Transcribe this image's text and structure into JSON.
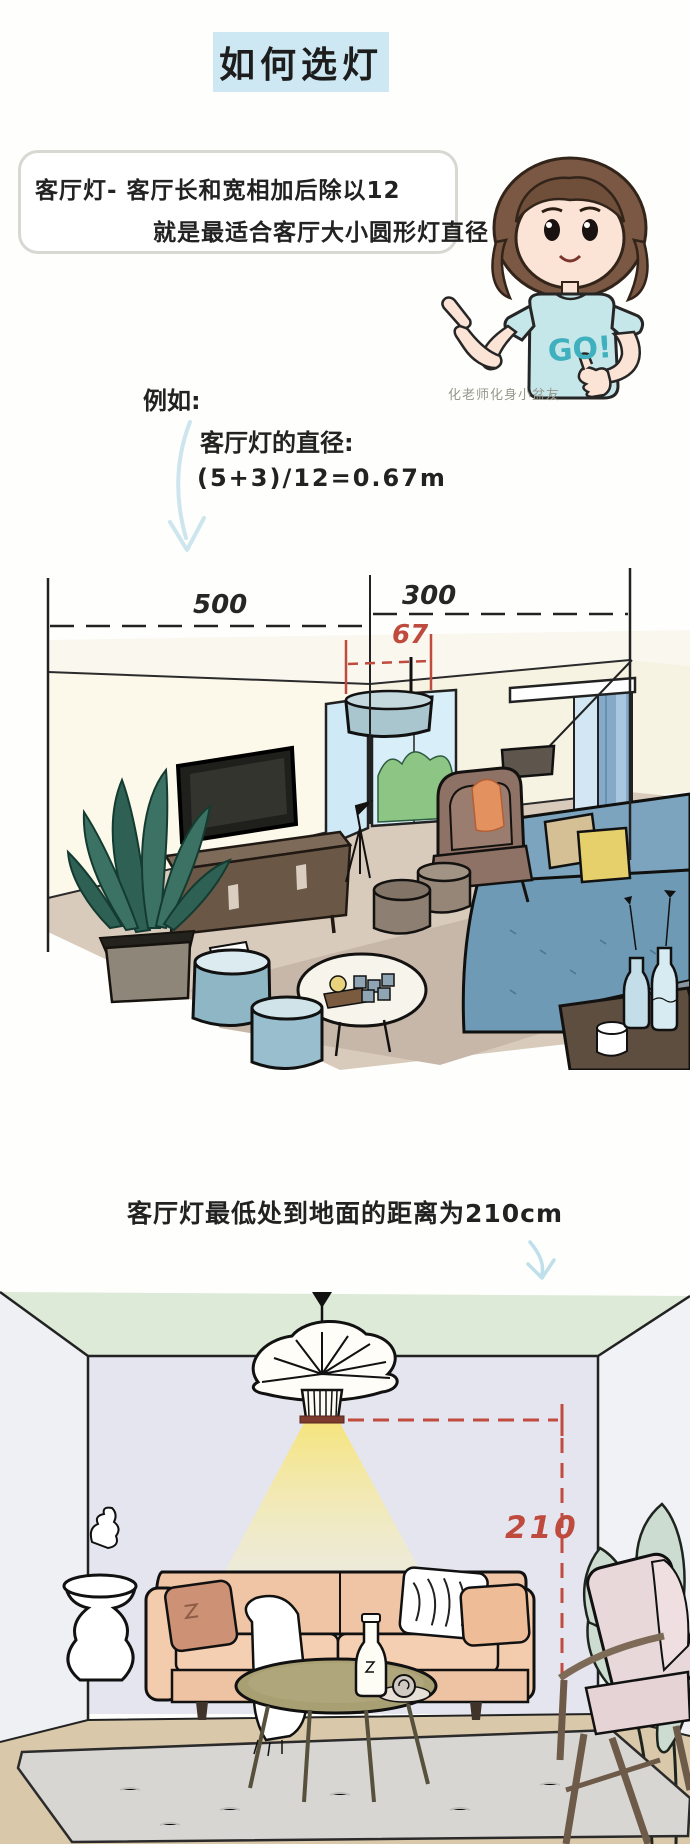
{
  "title": {
    "text": "如何选灯"
  },
  "speech_bubble": {
    "line1": "客厅灯- 客厅长和宽相加后除以12",
    "line2": "就是最适合客厅大小圆形灯直径"
  },
  "character": {
    "shirt_text": "GO!",
    "caption": "化老师化身小盆友"
  },
  "example": {
    "label": "例如:",
    "diameter_title": "客厅灯的直径:",
    "formula": "(5+3)/12=0.67m"
  },
  "top_diagram": {
    "room_width_label": "500",
    "room_depth_label": "300",
    "lamp_diameter_label": "67"
  },
  "bottom_section": {
    "caption": "客厅灯最低处到地面的距离为210cm",
    "lamp_height_label": "210"
  },
  "colors": {
    "title_bg": "#cde8f2",
    "measure_red": "#bf4a3e",
    "arrow_blue": "#c9e4ee",
    "light_yellow": "#f6e478"
  }
}
